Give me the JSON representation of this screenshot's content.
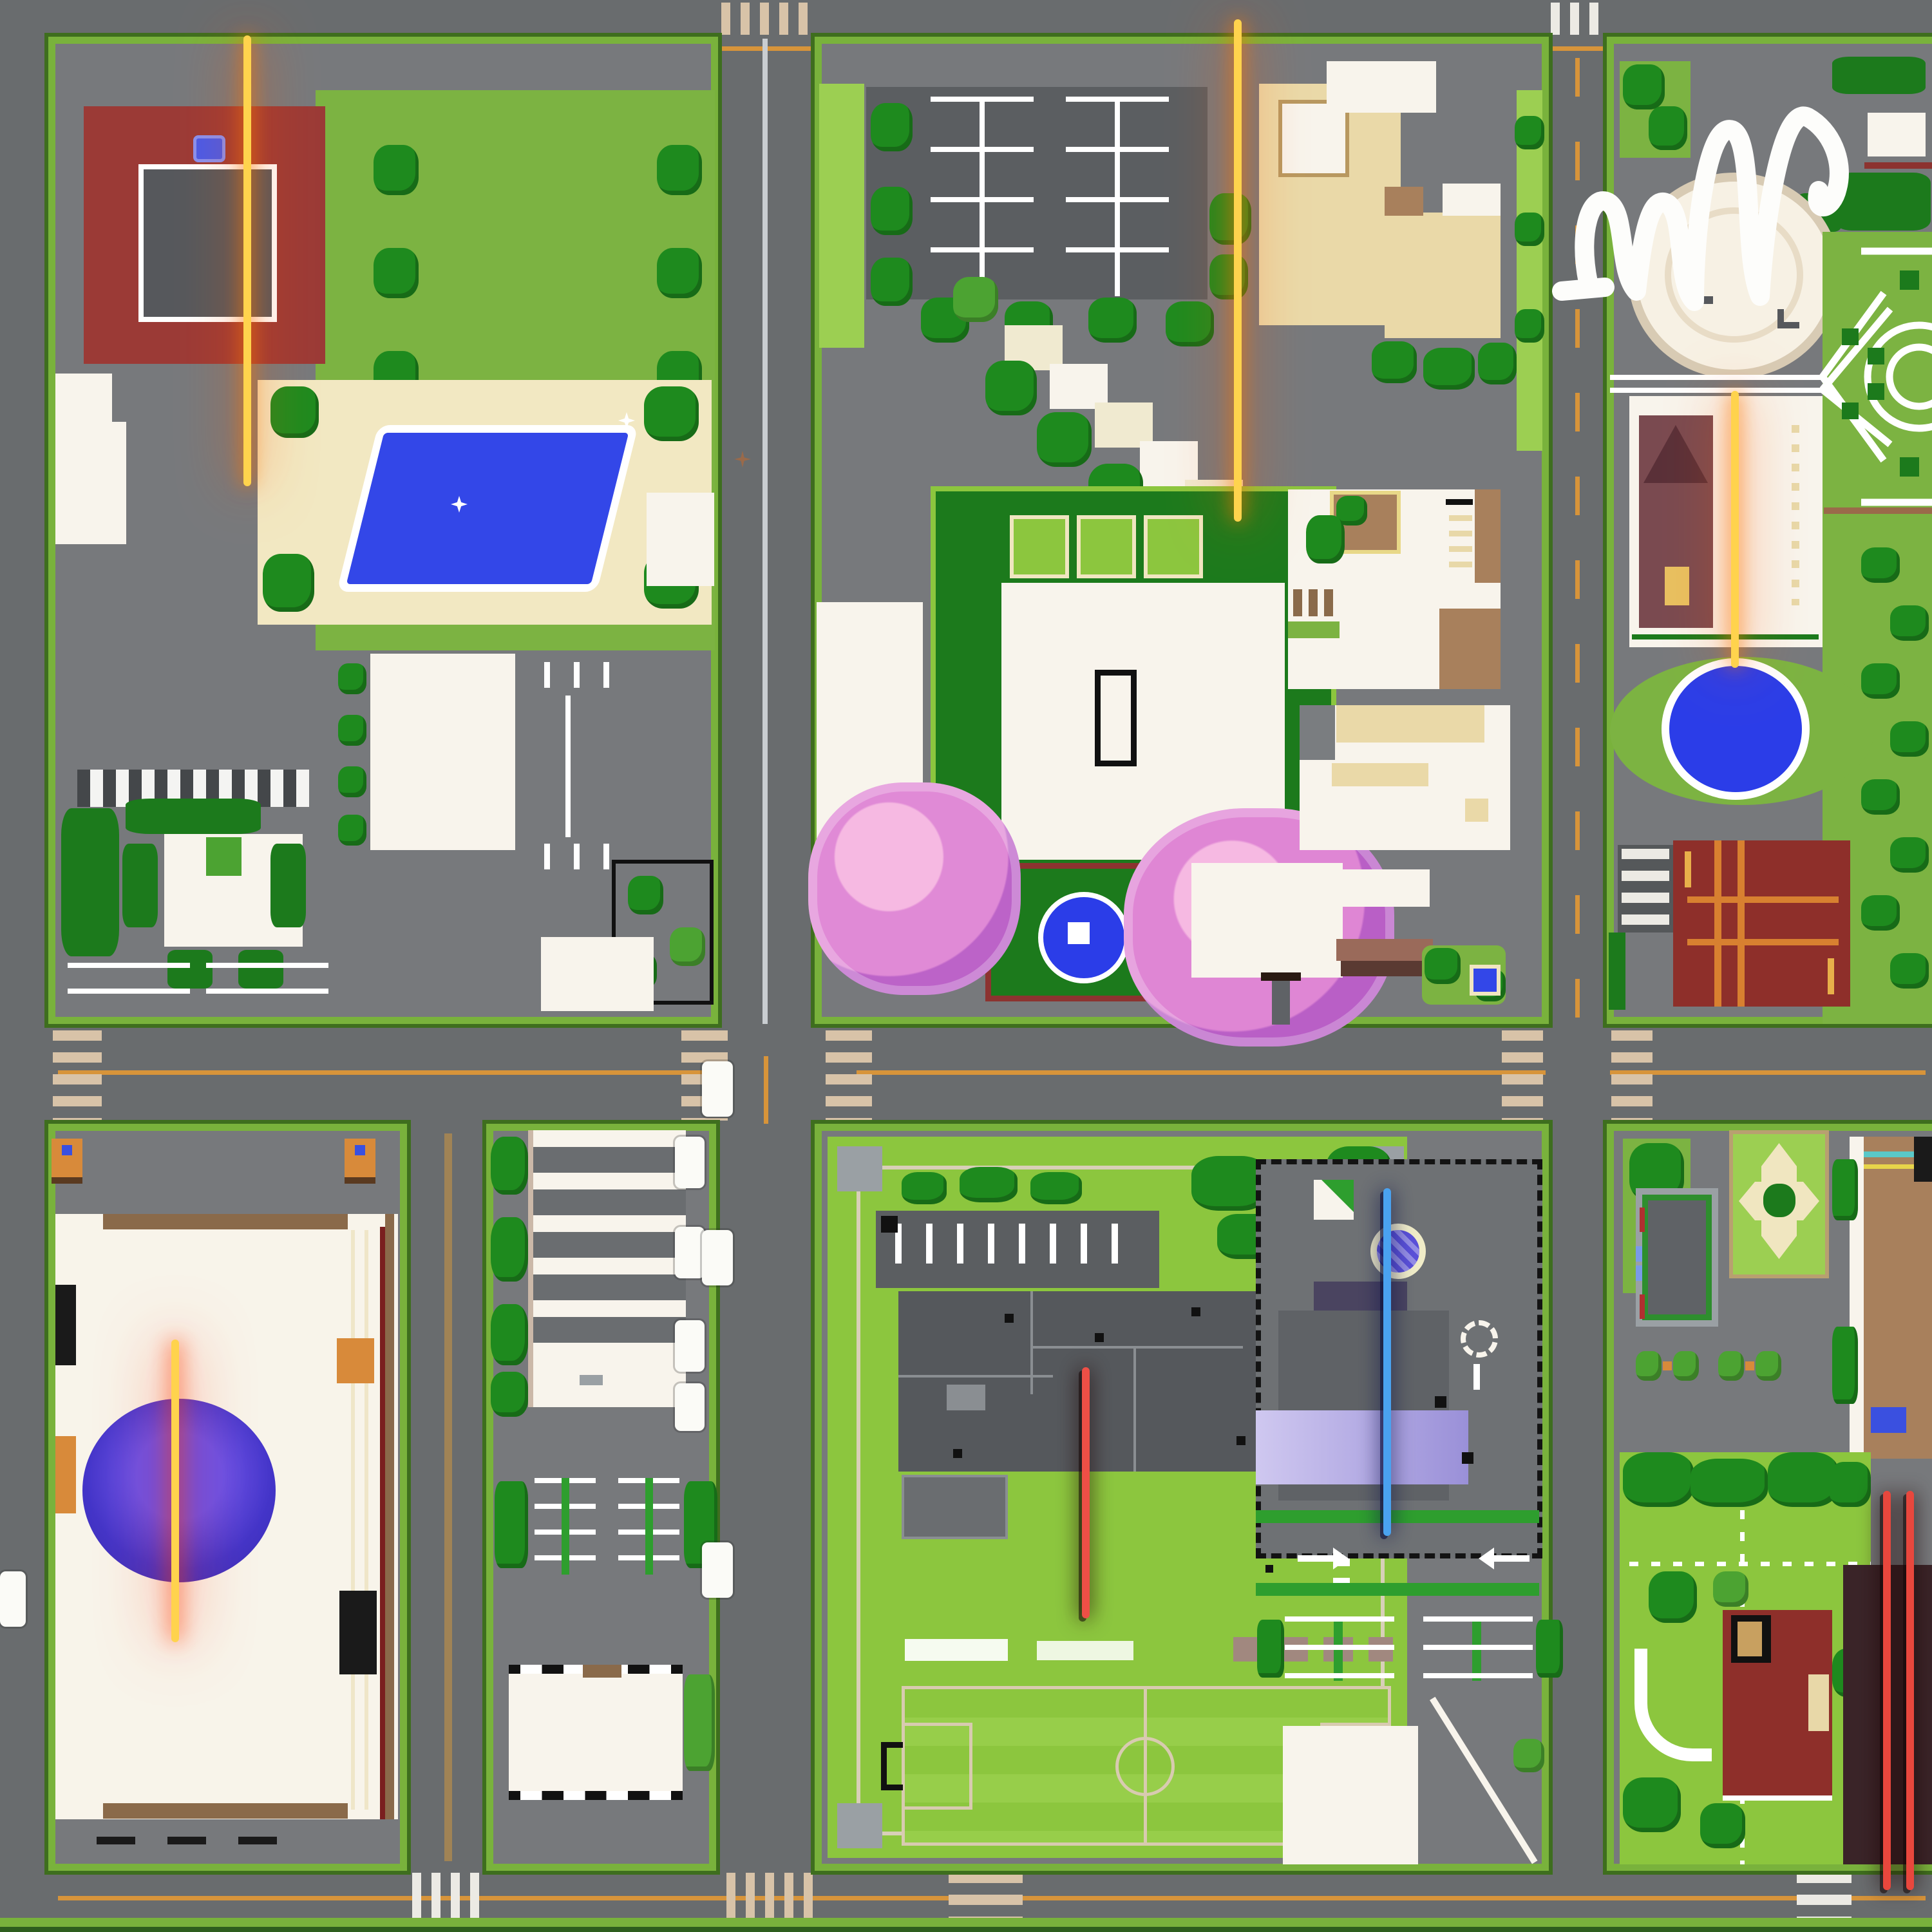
{
  "labels": {
    "mansion": "MANSION",
    "hospital": "HOSPITAL",
    "bank": "BANK",
    "mall": "MALL",
    "jail": "JAIL",
    "police": "POLICE",
    "market": "MARKET",
    "building_d": "D",
    "building_c": "C",
    "building_b": "B",
    "building_a": "A",
    "metro_m": "M"
  },
  "markers": {
    "scribble": "white-marker-scribble"
  },
  "colors": {
    "road": "#696c6e",
    "block_ground": "#77797c",
    "sidewalk_green": "#79b23c",
    "lawn_green": "#7cb342",
    "grass_light": "#8cc63e",
    "tree_green": "#1e8a1e",
    "sign_gold": "#ffd400",
    "sign_glow_orange": "#ff7a00",
    "jail_red": "#ee4f46",
    "police_blue": "#4aa2f0",
    "market_red": "#e8473d",
    "pool_blue": "#3347e8",
    "blossom_pink": "#e890d0",
    "mall_dome_blue": "#4a38d0",
    "mansion_red": "#9b3a36",
    "sand_patio": "#f2e8c2",
    "lane_orange": "#d7943a"
  }
}
